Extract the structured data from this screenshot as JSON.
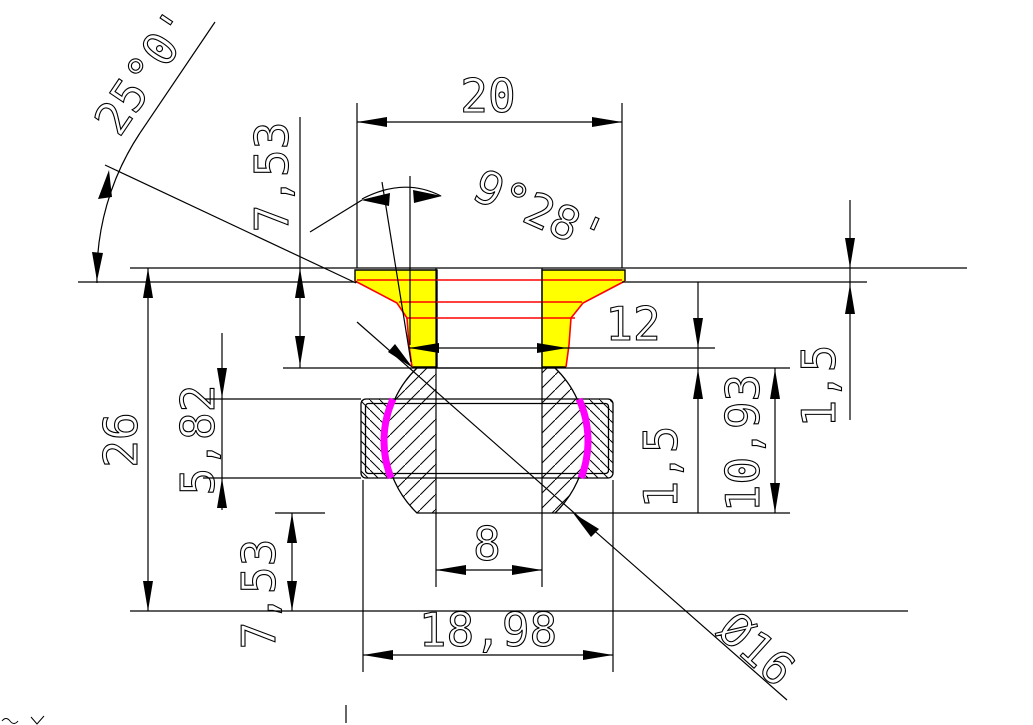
{
  "labels": {
    "width_top": "20",
    "angle_head": "25°0'",
    "height_head": "7,53",
    "angle_taper": "9°28'",
    "recess_depth": "1,5",
    "neck_width": "12",
    "height_total": "26",
    "ring_height": "5,82",
    "neck_clearance": "1,5",
    "ball_height": "10,93",
    "bore_width": "8",
    "offset_bottom": "7,53",
    "ring_width": "18,98",
    "ball_diameter": "Ø16"
  },
  "colors": {
    "head_fill": "#ffff00",
    "feature_lines": "#ff0000",
    "seal_arcs": "#ff00ff",
    "drawing_lines": "#000000",
    "background": "#ffffff"
  }
}
